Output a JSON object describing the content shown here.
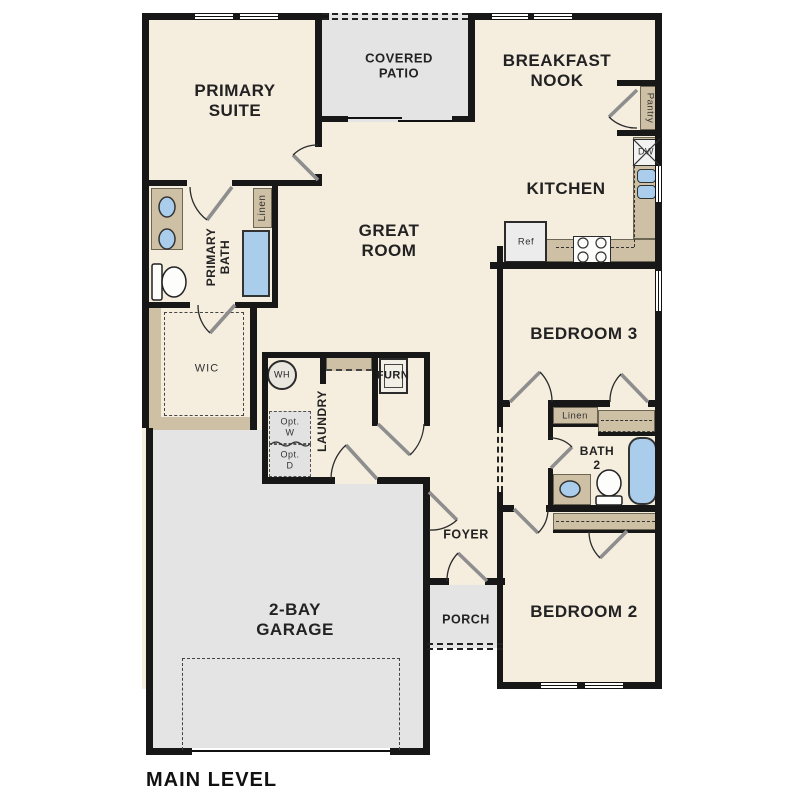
{
  "plan": {
    "title": "MAIN LEVEL",
    "labels": {
      "primary_suite": "PRIMARY\nSUITE",
      "covered_patio": "COVERED\nPATIO",
      "breakfast_nook": "BREAKFAST\nNOOK",
      "kitchen": "KITCHEN",
      "great_room": "GREAT\nROOM",
      "primary_bath": "PRIMARY\nBATH",
      "linen_primary": "Linen",
      "wic": "WIC",
      "wh": "WH",
      "furn": "FURN",
      "laundry": "LAUNDRY",
      "opt_w": "Opt.\nW",
      "opt_d": "Opt.\nD",
      "pantry": "Pantry",
      "dw": "DW",
      "ref": "Ref",
      "bedroom3": "BEDROOM 3",
      "linen_hall": "Linen",
      "bath2": "BATH\n2",
      "bedroom2": "BEDROOM 2",
      "foyer": "FOYER",
      "porch": "PORCH",
      "garage": "2-BAY\nGARAGE",
      "main_level": "MAIN LEVEL"
    },
    "colors": {
      "floor": "#f5edde",
      "hardscape": "#e4e4e4",
      "wall": "#171717",
      "counter": "#cec0a4",
      "fixture_blue": "#aacdec"
    }
  }
}
